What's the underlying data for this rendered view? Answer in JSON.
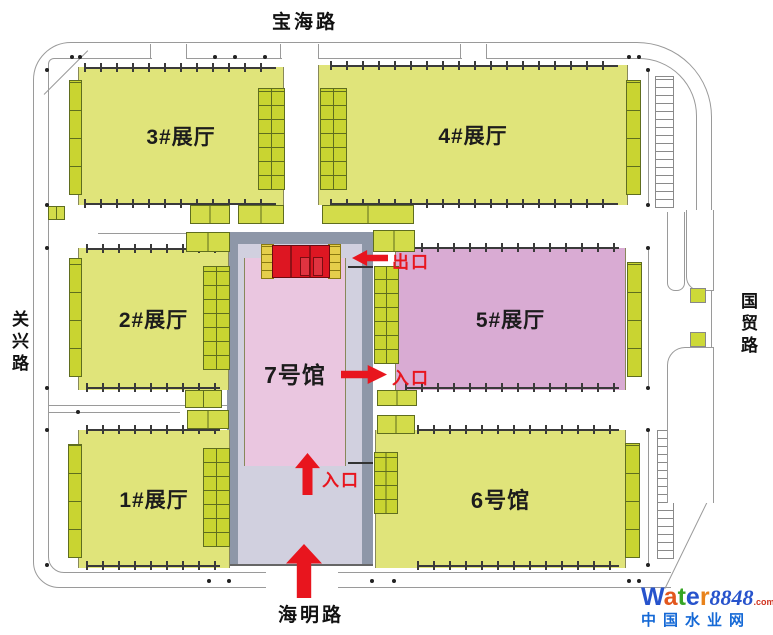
{
  "roads": {
    "top": "宝海路",
    "left": "关兴路",
    "right": "国贸路",
    "bottom": "海明路"
  },
  "halls": {
    "h1": "1#展厅",
    "h2": "2#展厅",
    "h3": "3#展厅",
    "h4": "4#展厅",
    "h5": "5#展厅",
    "h6": "6号馆",
    "h7": "7号馆"
  },
  "gates": {
    "exit": "出口",
    "entrance_mid": "入口",
    "entrance_bottom": "入口"
  },
  "colors": {
    "accent_red": "#e8151e",
    "hall_yellow": "#e0e47a",
    "dock_green": "#c9d431",
    "hall5_pink": "#d9abd3",
    "hall7_pink": "#eac6e0",
    "corridor_outer": "#8e97a8",
    "corridor_inner": "#d1d0df",
    "road_line": "#9a9a9a",
    "tick_dark": "#3a3a3a"
  },
  "watermark": {
    "letters": [
      "W",
      "a",
      "t",
      "e",
      "r"
    ],
    "letter_colors": [
      "#2753cc",
      "#e2571d",
      "#37a525",
      "#2753cc",
      "#e8821a"
    ],
    "number": "8848",
    "number_color": "#2753cc",
    "tld": ".com",
    "tld_color": "#d0331f",
    "subtitle": "中国水业网",
    "subtitle_color": "#1569d6"
  }
}
